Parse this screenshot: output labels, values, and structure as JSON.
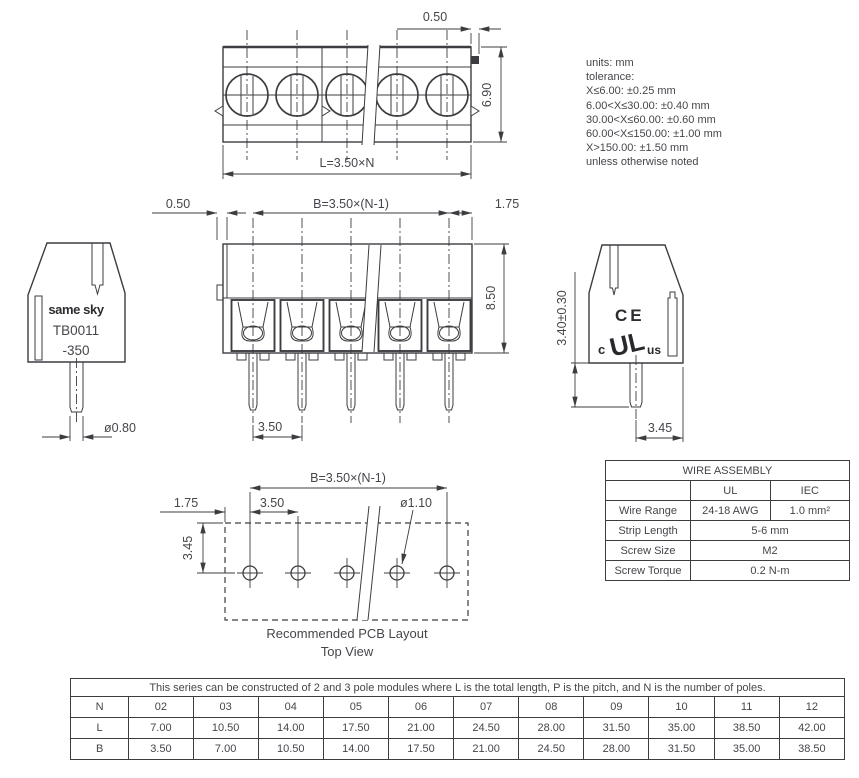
{
  "drawing": {
    "notes": [
      "units: mm",
      "tolerance:",
      "X≤6.00: ±0.25 mm",
      "6.00<X≤30.00: ±0.40 mm",
      "30.00<X≤60.00: ±0.60 mm",
      "60.00<X≤150.00: ±1.00 mm",
      "X>150.00: ±1.50 mm",
      "unless otherwise noted"
    ],
    "top_view": {
      "tab_offset": "0.50",
      "depth": "6.90",
      "total_length": "L=3.50×N"
    },
    "front_view": {
      "left_offset": "0.50",
      "pole_span": "B=3.50×(N-1)",
      "right_margin": "1.75",
      "height": "8.50",
      "pitch": "3.50"
    },
    "side_view_left": {
      "brand": "same sky",
      "part_number": "TB0011",
      "part_suffix": "-350",
      "pin_diameter": "ø0.80"
    },
    "side_view_right": {
      "ce_mark": "CE",
      "ul_mark_c": "c",
      "ul_mark": "UL",
      "ul_mark_us": "us",
      "pin_length": "3.40±0.30",
      "rear_offset": "3.45"
    },
    "pcb_layout": {
      "pole_span": "B=3.50×(N-1)",
      "edge_offset": "1.75",
      "pitch": "3.50",
      "hole_diameter": "ø1.10",
      "row_offset": "3.45",
      "caption_line1": "Recommended PCB Layout",
      "caption_line2": "Top View"
    }
  },
  "wire_assembly_table": {
    "title": "WIRE ASSEMBLY",
    "columns": {
      "ul": "UL",
      "iec": "IEC"
    },
    "rows": {
      "wire_range": {
        "label": "Wire Range",
        "ul": "24-18 AWG",
        "iec": "1.0 mm²"
      },
      "strip_length": {
        "label": "Strip Length",
        "value": "5-6 mm"
      },
      "screw_size": {
        "label": "Screw Size",
        "value": "M2"
      },
      "screw_torque": {
        "label": "Screw Torque",
        "value": "0.2 N-m"
      }
    }
  },
  "poles_table": {
    "caption": "This series can be constructed of 2 and 3 pole modules where L is the total length, P is the pitch, and N is the number of poles.",
    "rows": [
      {
        "label": "N",
        "values": [
          "02",
          "03",
          "04",
          "05",
          "06",
          "07",
          "08",
          "09",
          "10",
          "11",
          "12"
        ]
      },
      {
        "label": "L",
        "values": [
          "7.00",
          "10.50",
          "14.00",
          "17.50",
          "21.00",
          "24.50",
          "28.00",
          "31.50",
          "35.00",
          "38.50",
          "42.00"
        ]
      },
      {
        "label": "B",
        "values": [
          "3.50",
          "7.00",
          "10.50",
          "14.00",
          "17.50",
          "21.00",
          "24.50",
          "28.00",
          "31.50",
          "35.00",
          "38.50"
        ]
      }
    ]
  },
  "colors": {
    "line": "#3c3d41",
    "text": "#45464b"
  }
}
